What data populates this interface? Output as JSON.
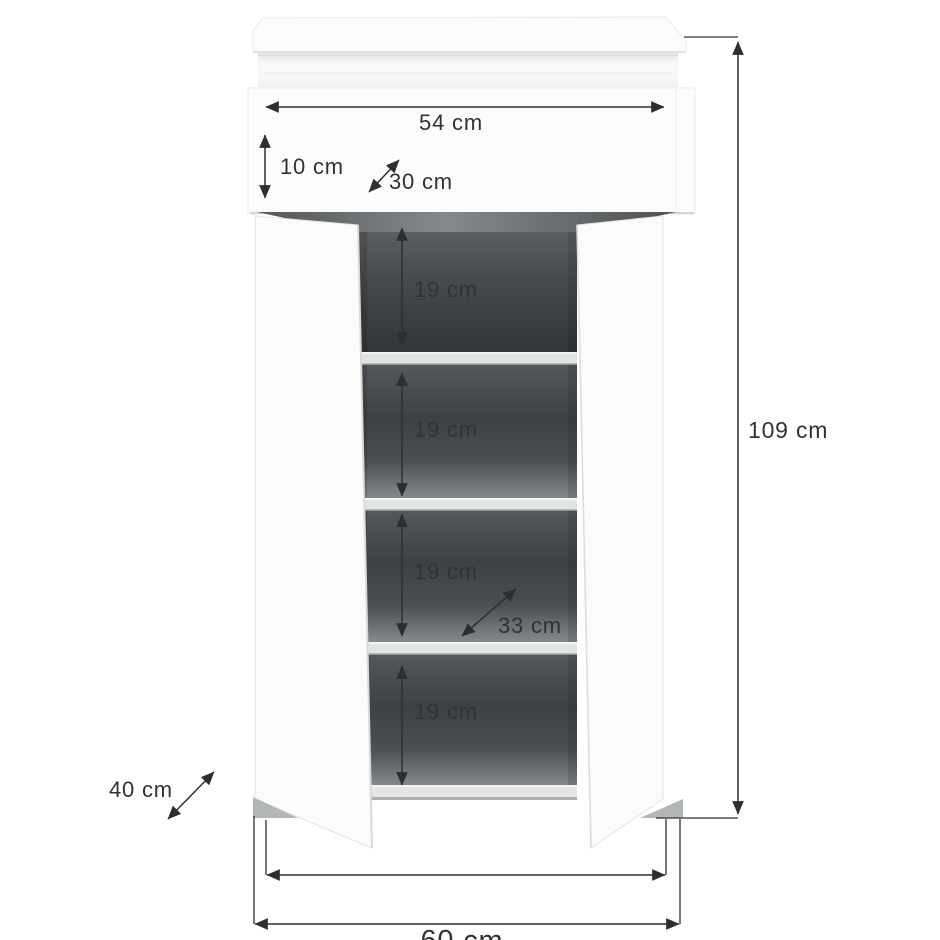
{
  "diagram": {
    "unit": "cm",
    "labels": {
      "top_width": "54 cm",
      "drawer_height": "10 cm",
      "top_depth": "30 cm",
      "compartment1_height": "19 cm",
      "compartment2_height": "19 cm",
      "compartment3_height": "19 cm",
      "compartment4_height": "19 cm",
      "total_height": "109 cm",
      "interior_depth": "33 cm",
      "side_depth": "40 cm",
      "bottom_width": "60 cm"
    },
    "colors": {
      "background": "#ffffff",
      "cabinet_body": "#fbfbfa",
      "interior_dark": "#424548",
      "shelf_light": "#e2e4e3",
      "dimension_line": "#2c2e30",
      "dimension_text": "#303335"
    }
  }
}
